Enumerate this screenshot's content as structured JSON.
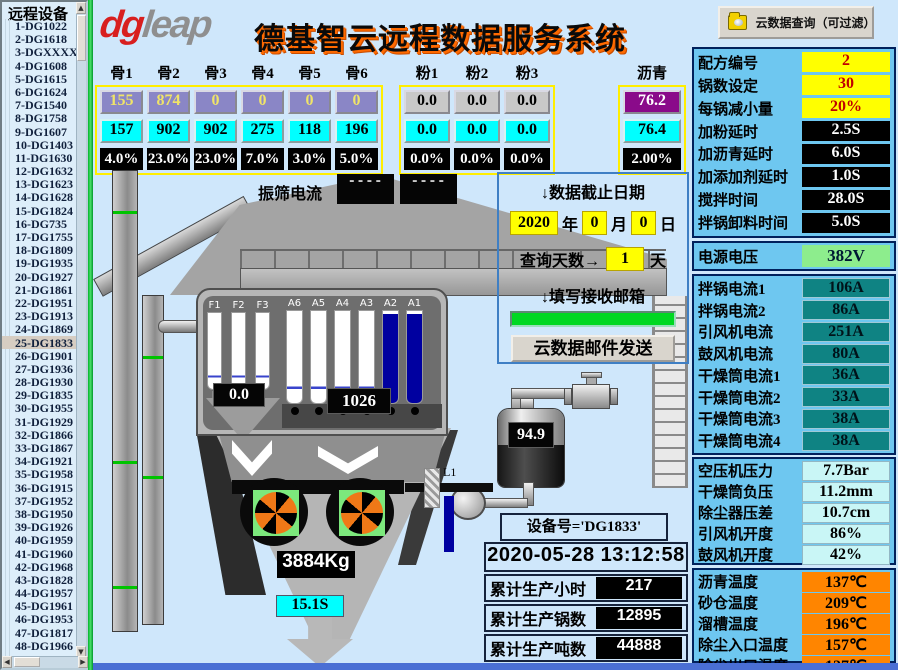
{
  "sidebar": {
    "title": "远程设备",
    "selected": "25-DG1833",
    "items": [
      "1-DG1022",
      "2-DG1618",
      "3-DGXXXX",
      "4-DG1608",
      "5-DG1615",
      "6-DG1624",
      "7-DG1540",
      "8-DG1758",
      "9-DG1607",
      "10-DG1403",
      "11-DG1630",
      "12-DG1632",
      "13-DG1623",
      "14-DG1628",
      "15-DG1824",
      "16-DG735",
      "17-DG1755",
      "18-DG1809",
      "19-DG1935",
      "20-DG1927",
      "21-DG1861",
      "22-DG1951",
      "23-DG1913",
      "24-DG1869",
      "25-DG1833",
      "26-DG1901",
      "27-DG1936",
      "28-DG1930",
      "29-DG1835",
      "30-DG1955",
      "31-DG1929",
      "32-DG1866",
      "33-DG1867",
      "34-DG1921",
      "35-DG1958",
      "36-DG1915",
      "37-DG1952",
      "38-DG1950",
      "39-DG1926",
      "40-DG1959",
      "41-DG1960",
      "42-DG1968",
      "43-DG1828",
      "44-DG1957",
      "45-DG1961",
      "46-DG1953",
      "47-DG1817",
      "48-DG1966"
    ],
    "scroll": {
      "up": "▲",
      "down": "▼",
      "left": "◀",
      "right": "▶"
    }
  },
  "header": {
    "logo": {
      "red": "dg",
      "gray": "leap"
    },
    "title": "德基智云远程数据服务系统",
    "query_button": "云数据查询（可过滤）"
  },
  "materials": {
    "groups": [
      {
        "name": "aggregate",
        "headers": [
          "骨1",
          "骨2",
          "骨3",
          "骨4",
          "骨5",
          "骨6"
        ],
        "set": [
          "155",
          "874",
          "0",
          "0",
          "0",
          "0"
        ],
        "actual": [
          "157",
          "902",
          "902",
          "275",
          "118",
          "196"
        ],
        "percent": [
          "4.0%",
          "23.0%",
          "23.0%",
          "7.0%",
          "3.0%",
          "5.0%"
        ]
      },
      {
        "name": "powder",
        "headers": [
          "粉1",
          "粉2",
          "粉3"
        ],
        "set": [
          "0.0",
          "0.0",
          "0.0"
        ],
        "actual": [
          "0.0",
          "0.0",
          "0.0"
        ],
        "percent": [
          "0.0%",
          "0.0%",
          "0.0%"
        ]
      },
      {
        "name": "bitumen",
        "headers": [
          "沥青"
        ],
        "set": [
          "76.2"
        ],
        "actual": [
          "76.4"
        ],
        "percent": [
          "2.00%"
        ]
      }
    ]
  },
  "diagram": {
    "vib_label": "振筛电流",
    "vib_values": [
      "----",
      "----"
    ],
    "filler_silos": [
      "F1",
      "F2",
      "F3"
    ],
    "agg_silos": [
      "A6",
      "A5",
      "A4",
      "A3",
      "A2",
      "A1"
    ],
    "filled_silos": [
      "A2",
      "A1"
    ],
    "filler_weight": "0.0",
    "agg_weight": "1026",
    "bitumen_weight": "94.9",
    "mix_weight": "3884Kg",
    "discharge_time": "15.1S",
    "pipe_label": "L1"
  },
  "query_panel": {
    "title": "↓数据截止日期",
    "year": "2020",
    "year_unit": "年",
    "month": "0",
    "month_unit": "月",
    "day": "0",
    "day_unit": "日",
    "days_label": "查询天数→",
    "days_value": "1",
    "days_unit": "天",
    "email_label": "↓填写接收邮箱",
    "email_value": "",
    "send_button": "云数据邮件发送"
  },
  "device_panel": {
    "name": "设备号='DG1833'",
    "datetime": "2020-05-28 13:12:58",
    "stats": [
      {
        "label": "累计生产小时",
        "value": "217"
      },
      {
        "label": "累计生产锅数",
        "value": "12895"
      },
      {
        "label": "累计生产吨数",
        "value": "44888"
      }
    ]
  },
  "right_panel": {
    "recipe": [
      {
        "label": "配方编号",
        "value": "2",
        "style": "yellow"
      },
      {
        "label": "锅数设定",
        "value": "30",
        "style": "yellow"
      },
      {
        "label": "每锅减小量",
        "value": "20%",
        "style": "yellow"
      },
      {
        "label": "加粉延时",
        "value": "2.5S",
        "style": "black"
      },
      {
        "label": "加沥青延时",
        "value": "6.0S",
        "style": "black"
      },
      {
        "label": "加添加剂延时",
        "value": "1.0S",
        "style": "black"
      },
      {
        "label": "搅拌时间",
        "value": "28.0S",
        "style": "black"
      },
      {
        "label": "拌锅卸料时间",
        "value": "5.0S",
        "style": "black"
      }
    ],
    "voltage": {
      "label": "电源电压",
      "value": "382V"
    },
    "currents": [
      {
        "label": "拌锅电流1",
        "value": "106A"
      },
      {
        "label": "拌锅电流2",
        "value": "86A"
      },
      {
        "label": "引风机电流",
        "value": "251A"
      },
      {
        "label": "鼓风机电流",
        "value": "80A"
      },
      {
        "label": "干燥筒电流1",
        "value": "36A"
      },
      {
        "label": "干燥筒电流2",
        "value": "33A"
      },
      {
        "label": "干燥筒电流3",
        "value": "38A"
      },
      {
        "label": "干燥筒电流4",
        "value": "38A"
      }
    ],
    "pressures": [
      {
        "label": "空压机压力",
        "value": "7.7Bar"
      },
      {
        "label": "干燥筒负压",
        "value": "11.2mm"
      },
      {
        "label": "除尘器压差",
        "value": "10.7cm"
      },
      {
        "label": "引风机开度",
        "value": "86%"
      },
      {
        "label": "鼓风机开度",
        "value": "42%"
      }
    ],
    "temperatures": [
      {
        "label": "沥青温度",
        "value": "137℃"
      },
      {
        "label": "砂仓温度",
        "value": "209℃"
      },
      {
        "label": "溜槽温度",
        "value": "196℃"
      },
      {
        "label": "除尘入口温度",
        "value": "157℃"
      },
      {
        "label": "除尘出口温度",
        "value": "127℃"
      }
    ]
  },
  "colors": {
    "bg_blue": "#cfe7fb",
    "panel_blue": "#6ec7f0",
    "accent_yellow": "#ffff00",
    "cyan": "#00ffff",
    "teal": "#0f8383",
    "orange": "#ff8500",
    "voltage_green": "#8ded8d",
    "email_green": "#00d822",
    "silo_fill": "#0000a0"
  }
}
